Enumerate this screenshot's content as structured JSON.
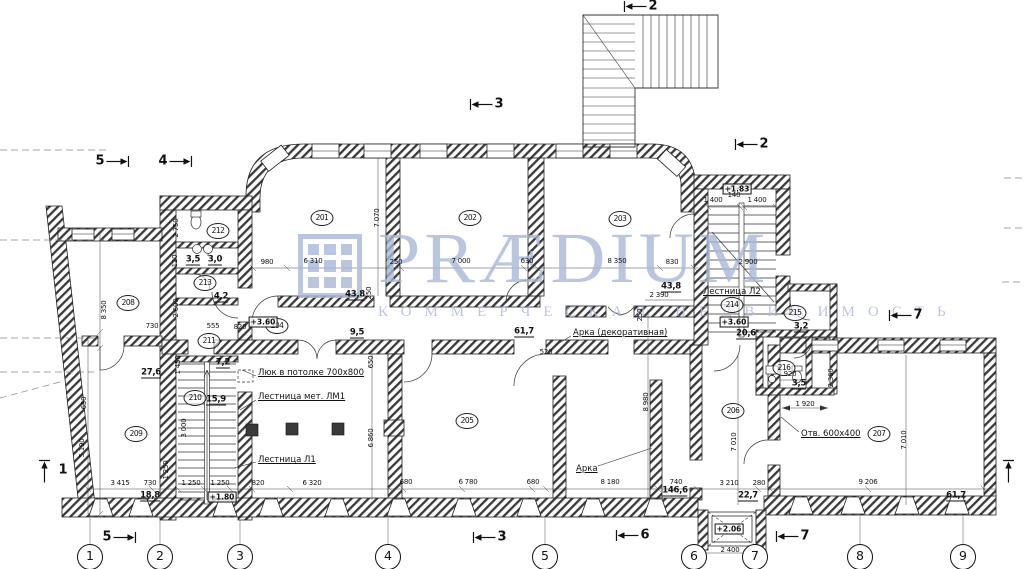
{
  "watermark": {
    "line1": "PRÆDIUM",
    "line2": "КОММЕРЧЕСКАЯ НЕДВИЖИМОСТЬ",
    "color": "#a9b9d8"
  },
  "rooms": [
    {
      "n": "201",
      "x": 322,
      "y": 218
    },
    {
      "n": "202",
      "x": 470,
      "y": 218
    },
    {
      "n": "203",
      "x": 620,
      "y": 219
    },
    {
      "n": "204",
      "x": 277,
      "y": 326
    },
    {
      "n": "205",
      "x": 467,
      "y": 421
    },
    {
      "n": "206",
      "x": 733,
      "y": 411
    },
    {
      "n": "207",
      "x": 879,
      "y": 434
    },
    {
      "n": "208",
      "x": 128,
      "y": 303
    },
    {
      "n": "209",
      "x": 136,
      "y": 434
    },
    {
      "n": "210",
      "x": 195,
      "y": 398
    },
    {
      "n": "211",
      "x": 209,
      "y": 341
    },
    {
      "n": "212",
      "x": 218,
      "y": 231
    },
    {
      "n": "213",
      "x": 205,
      "y": 283
    },
    {
      "n": "214",
      "x": 732,
      "y": 305
    },
    {
      "n": "215",
      "x": 795,
      "y": 313
    },
    {
      "n": "216",
      "x": 784,
      "y": 368
    }
  ],
  "areas": [
    {
      "v": "43,8",
      "x": 355,
      "y": 295
    },
    {
      "v": "43,8",
      "x": 671,
      "y": 287
    },
    {
      "v": "61,7",
      "x": 524,
      "y": 332
    },
    {
      "v": "27,6",
      "x": 151,
      "y": 373
    },
    {
      "v": "7,2",
      "x": 223,
      "y": 363
    },
    {
      "v": "15,9",
      "x": 216,
      "y": 400
    },
    {
      "v": "4,2",
      "x": 221,
      "y": 297
    },
    {
      "v": "3,5",
      "x": 193,
      "y": 260
    },
    {
      "v": "3,0",
      "x": 215,
      "y": 260
    },
    {
      "v": "9,5",
      "x": 357,
      "y": 333
    },
    {
      "v": "20,6",
      "x": 746,
      "y": 334
    },
    {
      "v": "3,2",
      "x": 801,
      "y": 327
    },
    {
      "v": "3,5",
      "x": 799,
      "y": 384
    },
    {
      "v": "18,8",
      "x": 150,
      "y": 496
    },
    {
      "v": "146,6",
      "x": 675,
      "y": 491
    },
    {
      "v": "22,7",
      "x": 748,
      "y": 496
    },
    {
      "v": "61,7",
      "x": 956,
      "y": 496
    }
  ],
  "levels": [
    {
      "v": "+3.60",
      "x": 263,
      "y": 322
    },
    {
      "v": "+1.83",
      "x": 737,
      "y": 189
    },
    {
      "v": "+3.60",
      "x": 734,
      "y": 322
    },
    {
      "v": "+1.80",
      "x": 222,
      "y": 497
    },
    {
      "v": "+2.06",
      "x": 729,
      "y": 529
    }
  ],
  "dims": [
    {
      "v": "980",
      "x": 267,
      "y": 262
    },
    {
      "v": "6 310",
      "x": 313,
      "y": 261
    },
    {
      "v": "250",
      "x": 396,
      "y": 262
    },
    {
      "v": "7 000",
      "x": 461,
      "y": 261
    },
    {
      "v": "630",
      "x": 527,
      "y": 261
    },
    {
      "v": "8 350",
      "x": 617,
      "y": 261
    },
    {
      "v": "830",
      "x": 672,
      "y": 262
    },
    {
      "v": "3 415",
      "x": 120,
      "y": 483
    },
    {
      "v": "730",
      "x": 150,
      "y": 483
    },
    {
      "v": "1 250",
      "x": 191,
      "y": 483
    },
    {
      "v": "1 250",
      "x": 220,
      "y": 483
    },
    {
      "v": "820",
      "x": 258,
      "y": 483
    },
    {
      "v": "6 320",
      "x": 312,
      "y": 483
    },
    {
      "v": "680",
      "x": 406,
      "y": 482
    },
    {
      "v": "6 780",
      "x": 468,
      "y": 482
    },
    {
      "v": "680",
      "x": 533,
      "y": 482
    },
    {
      "v": "8 180",
      "x": 610,
      "y": 482
    },
    {
      "v": "740",
      "x": 676,
      "y": 482
    },
    {
      "v": "3 210",
      "x": 729,
      "y": 483
    },
    {
      "v": "280",
      "x": 759,
      "y": 483
    },
    {
      "v": "9 206",
      "x": 868,
      "y": 482
    },
    {
      "v": "2 400",
      "x": 730,
      "y": 550
    },
    {
      "v": "730",
      "x": 152,
      "y": 326
    },
    {
      "v": "555",
      "x": 213,
      "y": 326
    },
    {
      "v": "820",
      "x": 240,
      "y": 327
    },
    {
      "v": "1 400",
      "x": 713,
      "y": 200
    },
    {
      "v": "140",
      "x": 734,
      "y": 195
    },
    {
      "v": "1 400",
      "x": 757,
      "y": 200
    },
    {
      "v": "2 900",
      "x": 748,
      "y": 262
    },
    {
      "v": "2 390",
      "x": 659,
      "y": 295
    },
    {
      "v": "520",
      "x": 546,
      "y": 352
    },
    {
      "v": "920",
      "x": 790,
      "y": 374
    },
    {
      "v": "1 920",
      "x": 805,
      "y": 404
    },
    {
      "v": "8 350",
      "x": 104,
      "y": 310,
      "r": -90
    },
    {
      "v": "650",
      "x": 84,
      "y": 403,
      "r": -90
    },
    {
      "v": "5 190",
      "x": 82,
      "y": 448,
      "r": -90
    },
    {
      "v": "7 070",
      "x": 377,
      "y": 218,
      "r": -90
    },
    {
      "v": "250",
      "x": 369,
      "y": 293,
      "r": -90
    },
    {
      "v": "2 750",
      "x": 176,
      "y": 228,
      "r": -90
    },
    {
      "v": "120",
      "x": 175,
      "y": 261,
      "r": -90
    },
    {
      "v": "2 600",
      "x": 176,
      "y": 308,
      "r": -90
    },
    {
      "v": "650",
      "x": 371,
      "y": 362,
      "r": -90
    },
    {
      "v": "6 860",
      "x": 371,
      "y": 438,
      "r": -90
    },
    {
      "v": "8 980",
      "x": 646,
      "y": 402,
      "r": -90
    },
    {
      "v": "7 010",
      "x": 734,
      "y": 442,
      "r": -90
    },
    {
      "v": "7 010",
      "x": 904,
      "y": 440,
      "r": -90
    },
    {
      "v": "250",
      "x": 640,
      "y": 315,
      "r": -90
    },
    {
      "v": "2 360",
      "x": 831,
      "y": 378,
      "r": -90
    },
    {
      "v": "1 450",
      "x": 178,
      "y": 365,
      "r": -90
    },
    {
      "v": "3 000",
      "x": 184,
      "y": 428,
      "r": -90
    },
    {
      "v": "1 250",
      "x": 166,
      "y": 470,
      "r": -90
    }
  ],
  "notes": [
    {
      "v": "Люк в потолке 700х800",
      "x": 258,
      "y": 373
    },
    {
      "v": "Лестница мет. ЛМ1",
      "x": 258,
      "y": 397
    },
    {
      "v": "Лестница Л1",
      "x": 258,
      "y": 460
    },
    {
      "v": "Лестница Л2",
      "x": 703,
      "y": 292
    },
    {
      "v": "Арка (декоративная)",
      "x": 573,
      "y": 333
    },
    {
      "v": "Арка",
      "x": 576,
      "y": 469
    },
    {
      "v": "Отв. 600х400",
      "x": 801,
      "y": 434
    }
  ],
  "grid_bubbles": [
    {
      "n": "1",
      "x": 90
    },
    {
      "n": "2",
      "x": 160
    },
    {
      "n": "3",
      "x": 240
    },
    {
      "n": "4",
      "x": 388
    },
    {
      "n": "5",
      "x": 545
    },
    {
      "n": "6",
      "x": 694
    },
    {
      "n": "7",
      "x": 755
    },
    {
      "n": "8",
      "x": 860
    },
    {
      "n": "9",
      "x": 963
    }
  ],
  "sections": [
    {
      "n": "5",
      "x": 113,
      "y": 161,
      "cls": "dir-right"
    },
    {
      "n": "4",
      "x": 176,
      "y": 161,
      "cls": "dir-right"
    },
    {
      "n": "3",
      "x": 486,
      "y": 104,
      "cls": "dir-left"
    },
    {
      "n": "2",
      "x": 640,
      "y": 6,
      "cls": "dir-left"
    },
    {
      "n": "2",
      "x": 751,
      "y": 144,
      "cls": "dir-left"
    },
    {
      "n": "7",
      "x": 905,
      "y": 315,
      "cls": "dir-left"
    },
    {
      "n": "1",
      "x": 50,
      "y": 470,
      "cls": "dir-up"
    },
    {
      "n": "1",
      "x": 1014,
      "y": 470,
      "cls": "dir-up"
    },
    {
      "n": "5",
      "x": 120,
      "y": 537,
      "cls": "dir-right"
    },
    {
      "n": "3",
      "x": 489,
      "y": 537,
      "cls": "dir-left"
    },
    {
      "n": "6",
      "x": 632,
      "y": 535,
      "cls": "dir-left"
    },
    {
      "n": "7",
      "x": 792,
      "y": 536,
      "cls": "dir-left"
    }
  ]
}
